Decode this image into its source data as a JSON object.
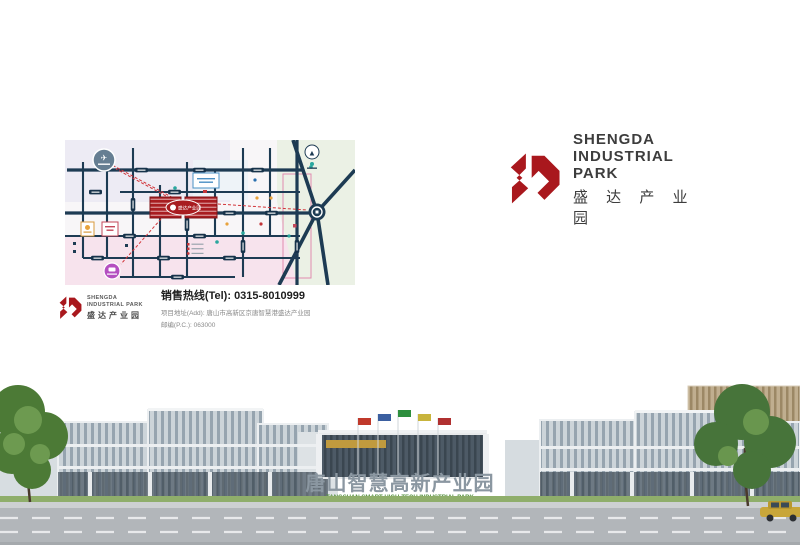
{
  "brand": {
    "line1": "SHENGDA",
    "line2": "INDUSTRIAL PARK",
    "cn": "盛 达 产 业 园"
  },
  "map": {
    "project_label": "盛达产业园",
    "airport_glyph": "✈",
    "compass_glyph": "▲"
  },
  "contact": {
    "logo_line1": "SHENGDA",
    "logo_line2": "INDUSTRIAL PARK",
    "logo_cn": "盛达产业园",
    "hotline_label": "销售热线(Tel):",
    "hotline_number": "0315-8010999",
    "address": "项目地址(Add): 唐山市高新区京唐智慧港盛达产业园",
    "postcode": "邮编(P.C.): 063000"
  },
  "panorama": {
    "gate_cn": "唐山智慧高新产业园",
    "gate_en": "TANGSHAN SMART HIGH-TECH INDUSTRIAL PARK"
  },
  "colors": {
    "brand_red": "#a9181d",
    "map_road": "#1d3b53",
    "map_pink": "#f7e3ed",
    "map_green": "#ebf1e5"
  }
}
